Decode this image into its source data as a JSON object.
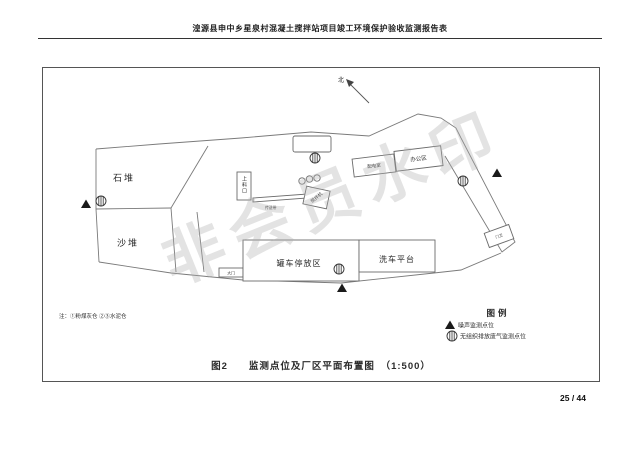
{
  "header": {
    "title": "湟源县申中乡星泉村混凝土搅拌站项目竣工环境保护验收监测报告表"
  },
  "watermark": "非会员水印",
  "figure": {
    "compass_label": "北",
    "areas": {
      "stone_pile": "石堆",
      "sand_pile": "沙堆",
      "feed_port": "上料口",
      "conveyor": "传送带",
      "mixer": "搅拌机",
      "power_room": "配电室",
      "office": "办公区",
      "gate_house": "门卫",
      "gate": "大门",
      "truck_parking": "罐车停放区",
      "wash_platform": "洗车平台"
    },
    "note": "注：①粉煤灰仓 ②③水泥仓",
    "legend": {
      "title": "图例",
      "noise": "噪声监测点位",
      "gas": "无组织排放废气监测点位"
    },
    "caption": "图2　　监测点位及厂区平面布置图　（1:500）"
  },
  "footer": {
    "page": "25 / 44"
  }
}
